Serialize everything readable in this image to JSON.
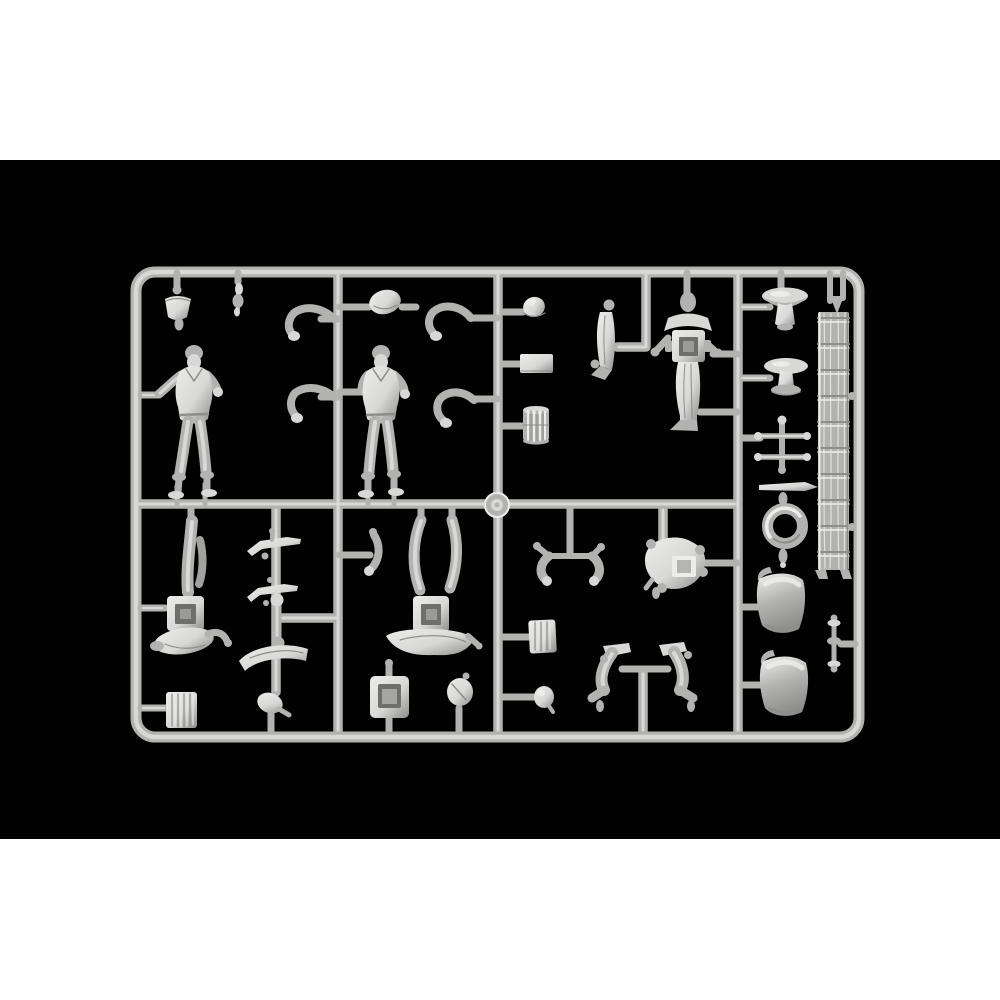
{
  "scene": {
    "description": "Product photo of a light-gray plastic model-kit sprue (injection runner frame) holding miniature soldier figures and accessory parts, centered on a black band across a white square canvas",
    "photo_area": {
      "x": 0,
      "y": 160,
      "width": 1000,
      "height": 679
    }
  },
  "colors": {
    "canvas": "#ffffff",
    "photo_bg": "#020202",
    "plastic_mid": "#b2b2b0",
    "plastic_light": "#d8d8d6",
    "plastic_hi": "#ececea",
    "plastic_dark": "#8d8d8b",
    "plastic_deep": "#6e6e6c"
  },
  "sprue": {
    "frame_shape": "rounded rectangle with three vertical runners and one horizontal mid runner forming six compartments plus a right-hand column",
    "gate_knob": "round injection gate medallion at center of frame",
    "parts": [
      {
        "id": "standing-soldier-1",
        "label": "standing soldier figure, arms out"
      },
      {
        "id": "standing-soldier-2",
        "label": "standing soldier figure, arms out"
      },
      {
        "id": "helmet-bucket-part",
        "label": "small bucket / helmet piece hanging from top rail"
      },
      {
        "id": "small-tool-part",
        "label": "tiny tool piece hanging from top rail"
      },
      {
        "id": "beret-blob-part",
        "label": "rounded cap piece above second figure"
      },
      {
        "id": "bent-arm-1",
        "label": "separate bent arm"
      },
      {
        "id": "bent-arm-2",
        "label": "separate bent arm"
      },
      {
        "id": "bent-arm-3",
        "label": "separate bent arm"
      },
      {
        "id": "bent-arm-4",
        "label": "separate bent arm"
      },
      {
        "id": "egg-helmet-part",
        "label": "egg-shaped helmet dome"
      },
      {
        "id": "flat-plate-part",
        "label": "flat rectangular plate"
      },
      {
        "id": "ribbed-drum-part",
        "label": "ribbed drum / pleated cylinder"
      },
      {
        "id": "greatcoat-figure-part",
        "label": "small figure in long coat, profile"
      },
      {
        "id": "backpack-figure-part",
        "label": "figure with square backpack and outstretched arms"
      },
      {
        "id": "round-table-1",
        "label": "round pedestal table"
      },
      {
        "id": "round-table-2",
        "label": "round pedestal table with base"
      },
      {
        "id": "cross-trestle-part",
        "label": "double cross-bar trestle"
      },
      {
        "id": "pointed-rod-part",
        "label": "horizontal rod with conical tip"
      },
      {
        "id": "life-ring-part",
        "label": "life ring / torus with pendant drops"
      },
      {
        "id": "curved-panel-1",
        "label": "curved shell panel"
      },
      {
        "id": "curved-panel-2",
        "label": "curved shell panel"
      },
      {
        "id": "stanchion-part",
        "label": "small flared stanchion by right rail"
      },
      {
        "id": "wooden-ladder-part",
        "label": "wood-grain ladder with ten rungs"
      },
      {
        "id": "inverted-pack-figure-1",
        "label": "inverted crouching figure with square pack"
      },
      {
        "id": "inverted-pack-figure-2",
        "label": "inverted sprawled figure with square pack"
      },
      {
        "id": "ribbed-crate-1",
        "label": "small ribbed crate"
      },
      {
        "id": "ribbed-crate-2",
        "label": "small ribbed crate"
      },
      {
        "id": "rifle-part-1",
        "label": "rifle / slung weapon"
      },
      {
        "id": "rifle-part-2",
        "label": "rifle / slung weapon"
      },
      {
        "id": "limb-part",
        "label": "small straight limb piece"
      },
      {
        "id": "curved-log-part",
        "label": "curved log / rolled item"
      },
      {
        "id": "hand-part",
        "label": "small hand piece"
      },
      {
        "id": "screen-box-part",
        "label": "square box with recessed panel"
      },
      {
        "id": "small-blob-part",
        "label": "small irregular piece"
      },
      {
        "id": "arm-pair-part",
        "label": "pair of bent arms on cross stub"
      },
      {
        "id": "boot-pair-part",
        "label": "pair of tall boots on cross stub"
      },
      {
        "id": "round-pack-figure-part",
        "label": "top view figure with bright square pack"
      },
      {
        "id": "dome-ball-part",
        "label": "small dome / ball piece"
      },
      {
        "id": "small-arm-part",
        "label": "small vertical arm piece"
      },
      {
        "id": "sprue-gate-knob",
        "label": "central round gate knob"
      }
    ]
  }
}
